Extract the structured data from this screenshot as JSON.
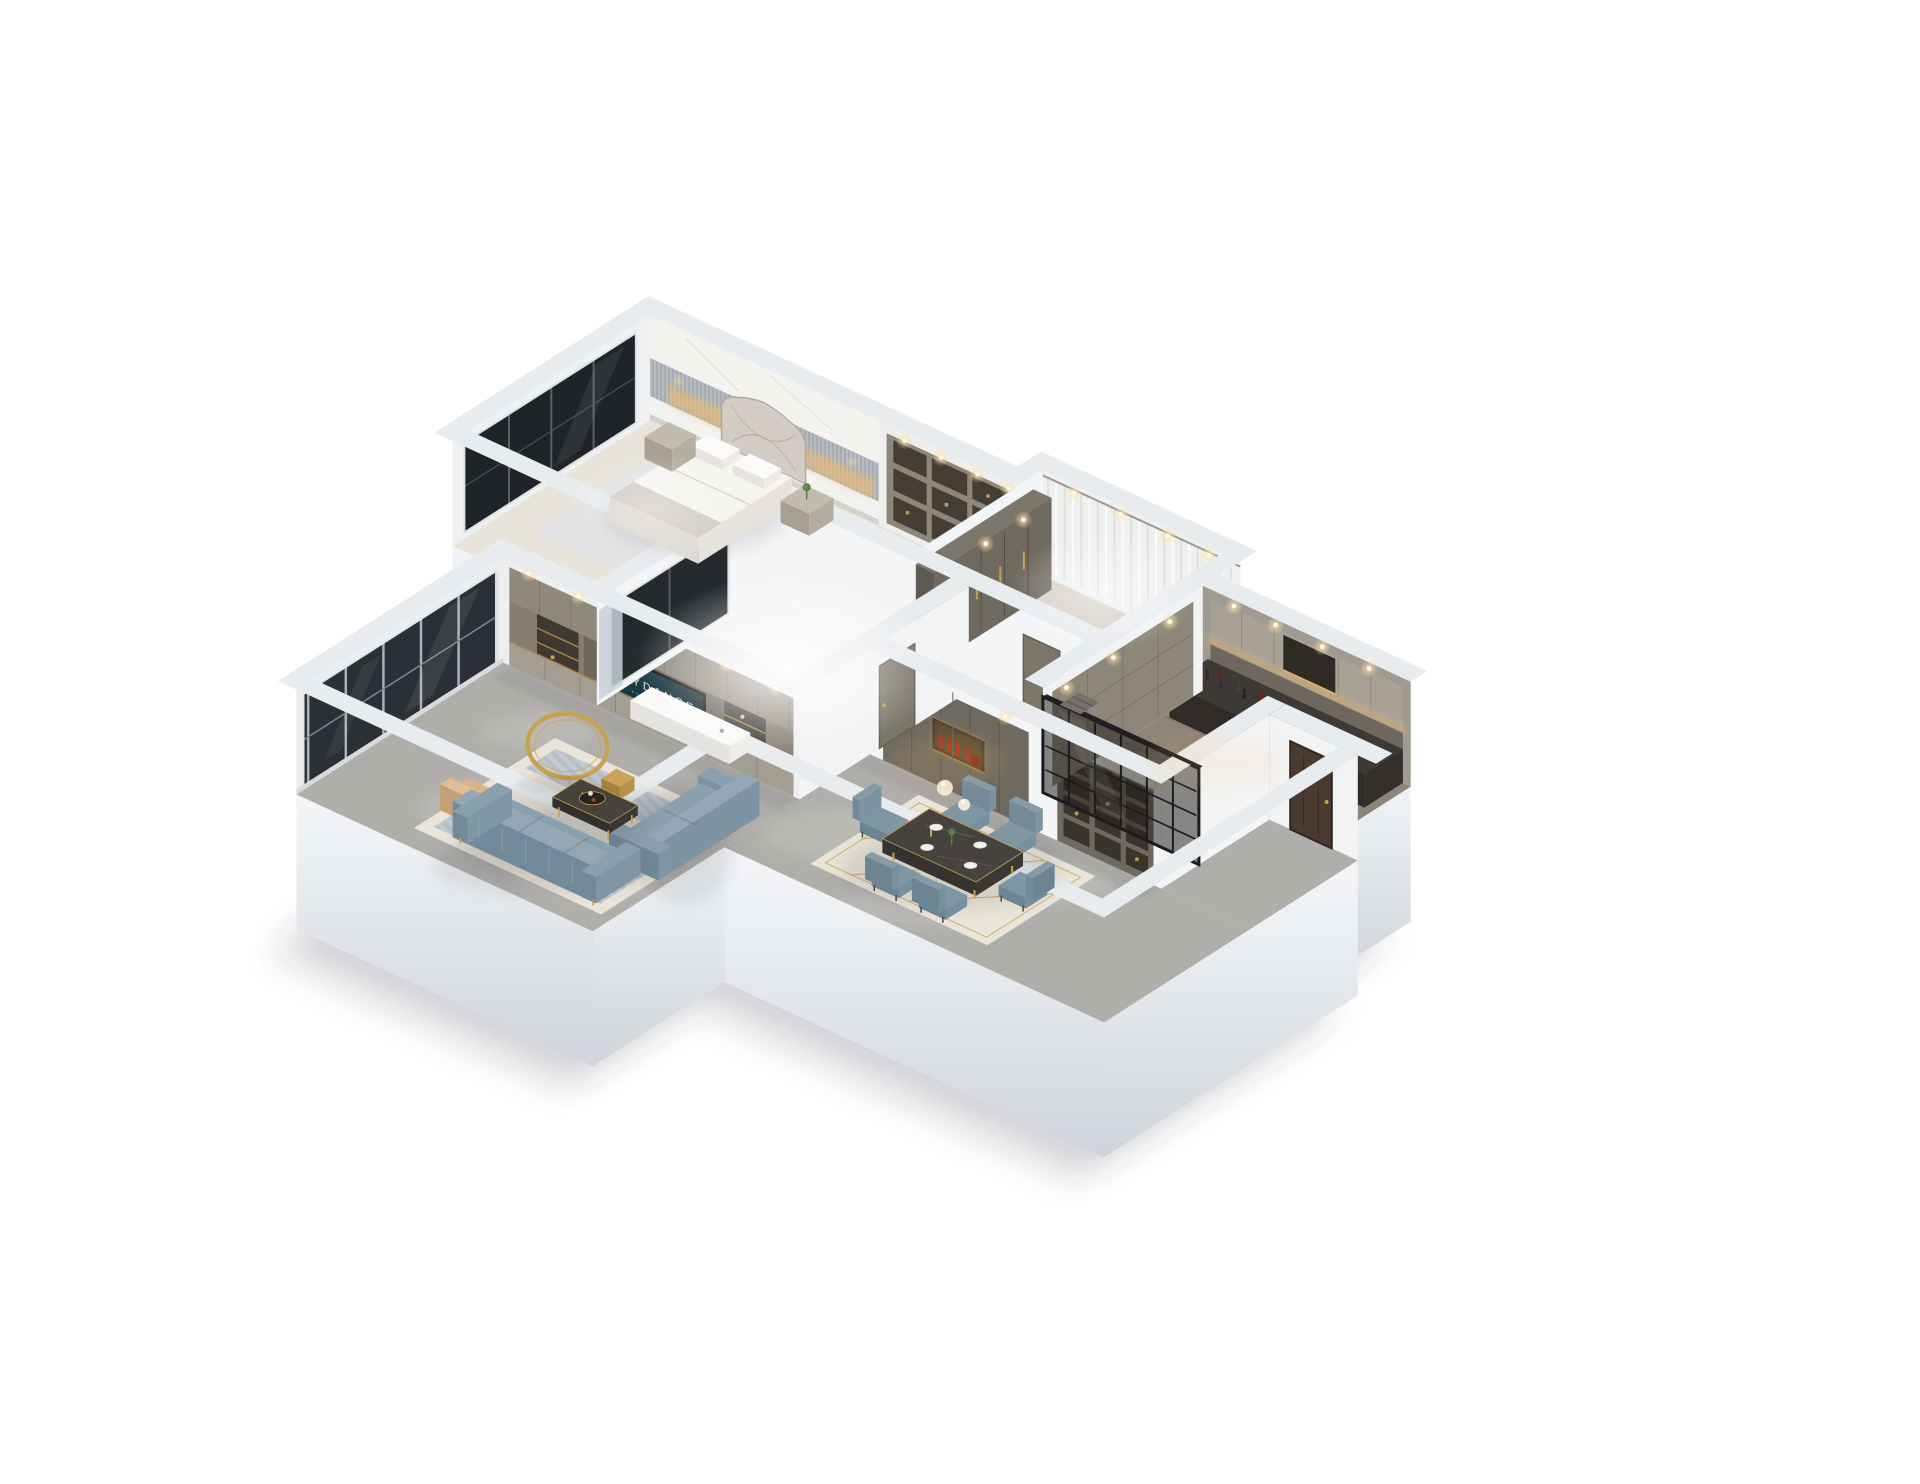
{
  "scene": {
    "type": "3d-floor-plan-dollhouse-render",
    "background": "#ffffff",
    "tv": {
      "brand": "SKYDANCE",
      "subtitle": "PRODUCTIONS",
      "screen_color": "#14323a"
    },
    "rooms": [
      {
        "id": "master-bedroom",
        "items": [
          "double-bed",
          "quilted-headboard",
          "pillows",
          "nightstand",
          "plant",
          "cove-lighting",
          "marble-accent-wall",
          "window-glazing"
        ]
      },
      {
        "id": "walk-in-closet",
        "items": [
          "open-cube-shelving",
          "downlights"
        ]
      },
      {
        "id": "dressing-room",
        "items": [
          "sheer-curtains",
          "wardrobe-cabinets",
          "gold-handles",
          "floor-drain",
          "downlights"
        ]
      },
      {
        "id": "kitchen",
        "items": [
          "upper-cabinets",
          "under-cabinet-lighting",
          "backsplash",
          "counter",
          "wine-bottles",
          "range-hood",
          "glass-partition"
        ]
      },
      {
        "id": "bedroom-2",
        "items": [
          "desk",
          "window-glazing",
          "overexposed-daylight"
        ]
      },
      {
        "id": "hallway",
        "items": [
          "interior-door"
        ]
      },
      {
        "id": "entry",
        "items": [
          "entry-door"
        ]
      },
      {
        "id": "dining-room",
        "items": [
          "dining-table",
          "six-chairs",
          "area-rug",
          "pendant-lamp",
          "sideboard-cabinet",
          "red-glassware-niche",
          "display-shelving",
          "downlights"
        ]
      },
      {
        "id": "living-room",
        "items": [
          "tv-wall-unit",
          "tv-screen",
          "downlights",
          "main-sofa",
          "side-sofa",
          "coffee-table",
          "coffee-tray",
          "gold-ring-decor",
          "gold-stool",
          "accent-chair",
          "area-rug",
          "balcony-glazing"
        ]
      }
    ],
    "colors": {
      "wall_top": "#e9ecef",
      "wall_interior": "#f4f5f6",
      "floor_marble": "#b0aeab",
      "floor_bedroom": "#e9e4da",
      "floor_closet": "#d8d2c7",
      "floor_dressing": "#d6d0c6",
      "floor_kitchen": "#8e8579",
      "floor_white_room": "#f4f3f1",
      "cabinet_olive": "#6f6a60",
      "tv_wall": "#847d70",
      "drawer_light": "#a49e92",
      "wood_accent": "#a7804f",
      "sofa_blue": "#8ba0ae",
      "sofa_blue_dark": "#72899a",
      "rug_blue": "#b7c0c8",
      "rug_cream": "#eae5da",
      "gold": "#c8a24e",
      "table_marble": "#46423e",
      "glass_dark": "#26292d",
      "frame_black": "#1b1b1d",
      "curtain": "#eef0ee",
      "warm_glow": "#f3bb66",
      "red_accent": "#b23222",
      "tan_chair": "#d7b489",
      "marble_wall": "#f3f2ee",
      "rib_wall": "#b7bbc1",
      "door_walnut": "#4a3a30",
      "door_olive": "#7b756a",
      "shadow": "rgba(75,80,92,0.18)"
    }
  }
}
